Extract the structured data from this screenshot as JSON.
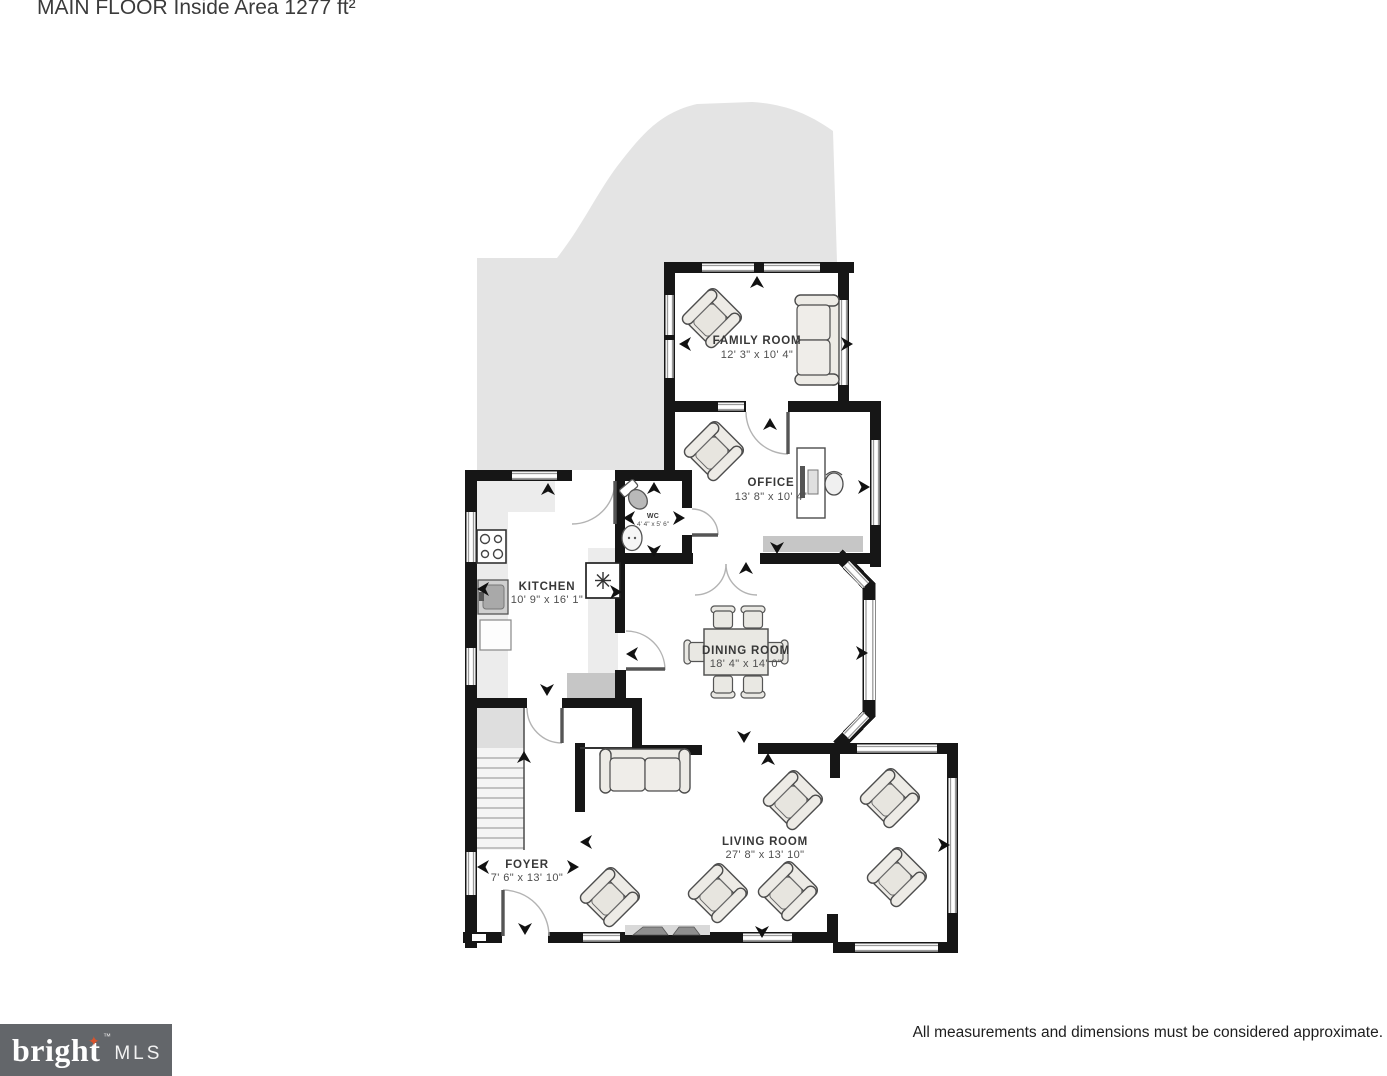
{
  "title": "MAIN FLOOR Inside Area 1277 ft²",
  "footer": {
    "disclaimer": "All measurements and dimensions must be considered approximate.",
    "logo": {
      "brand": "bright",
      "tm": "™",
      "suffix": "MLS"
    }
  },
  "plan": {
    "rooms": [
      {
        "name": "FAMILY ROOM",
        "dimensions": "12' 3\" x 10' 4\""
      },
      {
        "name": "OFFICE",
        "dimensions": "13' 8\" x 10' 4\""
      },
      {
        "name": "WC",
        "dimensions": "4' 4\" x 5' 6\""
      },
      {
        "name": "KITCHEN",
        "dimensions": "10' 9\" x 16' 1\""
      },
      {
        "name": "DINING ROOM",
        "dimensions": "18' 4\" x 14' 0\""
      },
      {
        "name": "LIVING ROOM",
        "dimensions": "27' 8\" x 13' 10\""
      },
      {
        "name": "FOYER",
        "dimensions": "7' 6\" x 13' 10\""
      }
    ],
    "camera_arrows": [
      {
        "x": 757,
        "y": 283,
        "deg": 270
      },
      {
        "x": 686,
        "y": 344,
        "deg": 180
      },
      {
        "x": 846,
        "y": 344,
        "deg": 0
      },
      {
        "x": 770,
        "y": 425,
        "deg": 270
      },
      {
        "x": 863,
        "y": 487,
        "deg": 0
      },
      {
        "x": 777,
        "y": 547,
        "deg": 90
      },
      {
        "x": 654,
        "y": 489,
        "deg": 270
      },
      {
        "x": 630,
        "y": 518,
        "deg": 180
      },
      {
        "x": 678,
        "y": 518,
        "deg": 0
      },
      {
        "x": 654,
        "y": 550,
        "deg": 90
      },
      {
        "x": 548,
        "y": 490,
        "deg": 270
      },
      {
        "x": 484,
        "y": 589,
        "deg": 180
      },
      {
        "x": 615,
        "y": 592,
        "deg": 0
      },
      {
        "x": 547,
        "y": 689,
        "deg": 90
      },
      {
        "x": 633,
        "y": 654,
        "deg": 180
      },
      {
        "x": 746,
        "y": 569,
        "deg": 270
      },
      {
        "x": 744,
        "y": 736,
        "deg": 90
      },
      {
        "x": 768,
        "y": 760,
        "deg": 270
      },
      {
        "x": 861,
        "y": 653,
        "deg": 0
      },
      {
        "x": 587,
        "y": 842,
        "deg": 180
      },
      {
        "x": 943,
        "y": 845,
        "deg": 0
      },
      {
        "x": 762,
        "y": 931,
        "deg": 90
      },
      {
        "x": 484,
        "y": 867,
        "deg": 180
      },
      {
        "x": 572,
        "y": 867,
        "deg": 0
      },
      {
        "x": 525,
        "y": 928,
        "deg": 90
      },
      {
        "x": 524,
        "y": 758,
        "deg": 270
      }
    ],
    "colors": {
      "wall": "#161616",
      "deck": "#e4e4e4",
      "counter": "#ececec",
      "furniture_fill": "#edebe6",
      "furniture_stroke": "#4d4d4d",
      "shaded_area": "#c6c6c6",
      "logo_background": "#63666a",
      "logo_star": "#d9532c",
      "label_text": "#383838"
    }
  }
}
